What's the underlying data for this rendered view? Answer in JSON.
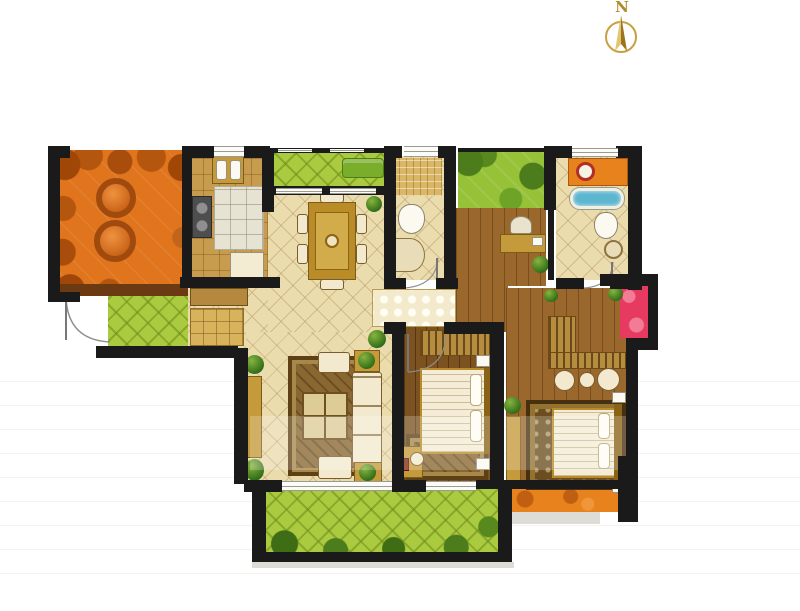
{
  "compass": {
    "label": "N",
    "icon": "north-arrow-icon"
  },
  "palette": {
    "wall": "#1a1a1a",
    "tile": "#ebdcae",
    "kitchen": "#c79c4e",
    "wood1": "#9a682c",
    "wood2": "#7c5220",
    "green1": "#aaca40",
    "green2": "#96c238",
    "orange1": "#e0751e",
    "orange2": "#e8821c",
    "red1": "#e63a60",
    "gold": "#c49a3a",
    "golddark": "#7c5c1a",
    "fabric": "#f2e9cf",
    "tub": "#5cb6d0",
    "mosaic": "#d9b766"
  }
}
